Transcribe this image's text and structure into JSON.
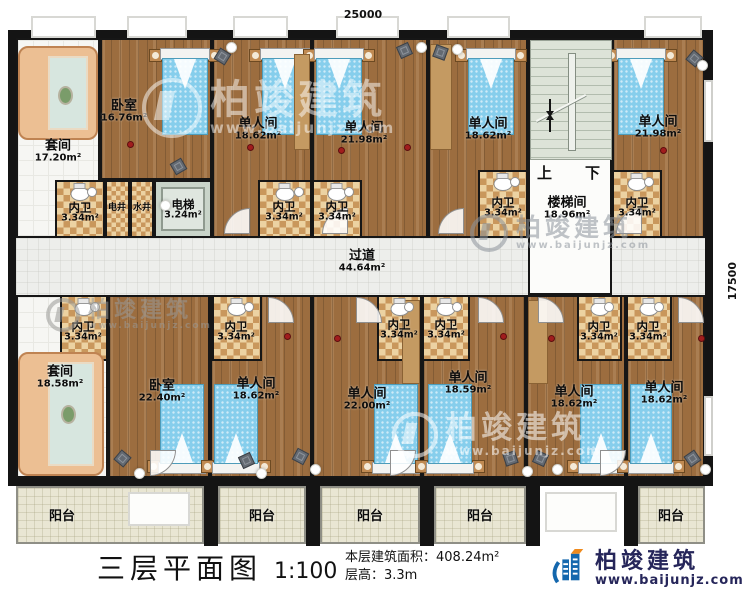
{
  "watermark": {
    "brand": "柏竣建筑",
    "url": "www.baijunjz.com"
  },
  "title_block": {
    "title": "三层平面图",
    "scale": "1:100",
    "area_line": "本层建筑面积：408.24m²",
    "height_line": "层高：3.3m",
    "brand": "柏竣建筑",
    "website": "www.baijunjz.com"
  },
  "plan": {
    "dims": {
      "top": "25000",
      "right": "17500"
    },
    "stairs": {
      "up": "上",
      "down": "下"
    },
    "rooms": [
      {
        "id": "room-suite-top",
        "type": "suite",
        "name": "套间",
        "area": "17.20m²",
        "x": 16,
        "y": 38,
        "w": 84,
        "h": 200,
        "lx": 58,
        "ly": 152
      },
      {
        "id": "room-bedroom-top",
        "type": "wood",
        "name": "卧室",
        "area": "16.76m²",
        "x": 100,
        "y": 38,
        "w": 112,
        "h": 142,
        "lx": 124,
        "ly": 112
      },
      {
        "id": "room-single-top-1",
        "type": "wood",
        "name": "单人间",
        "area": "18.62m²",
        "x": 212,
        "y": 38,
        "w": 100,
        "h": 200,
        "lx": 258,
        "ly": 130
      },
      {
        "id": "room-single-top-2",
        "type": "wood",
        "name": "单人间",
        "area": "21.98m²",
        "x": 312,
        "y": 38,
        "w": 116,
        "h": 200,
        "lx": 364,
        "ly": 134
      },
      {
        "id": "room-single-top-3",
        "type": "wood",
        "name": "单人间",
        "area": "18.62m²",
        "x": 428,
        "y": 38,
        "w": 100,
        "h": 200,
        "lx": 488,
        "ly": 130
      },
      {
        "id": "room-single-top-4",
        "type": "wood",
        "name": "单人间",
        "area": "21.98m²",
        "x": 612,
        "y": 38,
        "w": 93,
        "h": 200,
        "lx": 658,
        "ly": 128
      },
      {
        "id": "room-corridor",
        "type": "corridor",
        "name": "过道",
        "area": "44.64m²",
        "x": 16,
        "y": 238,
        "w": 689,
        "h": 57,
        "lx": 362,
        "ly": 262
      },
      {
        "id": "room-stairwell",
        "type": "stairw",
        "name": "楼梯间",
        "area": "18.96m²",
        "x": 528,
        "y": 38,
        "w": 84,
        "h": 257,
        "lx": 567,
        "ly": 209
      },
      {
        "id": "room-suite-bottom",
        "type": "suite",
        "name": "套间",
        "area": "18.58m²",
        "x": 16,
        "y": 295,
        "w": 92,
        "h": 183,
        "lx": 60,
        "ly": 378
      },
      {
        "id": "room-bedroom-bottom",
        "type": "wood",
        "name": "卧室",
        "area": "22.40m²",
        "x": 108,
        "y": 295,
        "w": 102,
        "h": 183,
        "lx": 162,
        "ly": 392
      },
      {
        "id": "room-single-bot-1",
        "type": "wood",
        "name": "单人间",
        "area": "18.62m²",
        "x": 210,
        "y": 295,
        "w": 102,
        "h": 183,
        "lx": 256,
        "ly": 390
      },
      {
        "id": "room-single-bot-2",
        "type": "wood",
        "name": "单人间",
        "area": "22.00m²",
        "x": 312,
        "y": 295,
        "w": 110,
        "h": 183,
        "lx": 367,
        "ly": 400
      },
      {
        "id": "room-single-bot-3",
        "type": "wood",
        "name": "单人间",
        "area": "18.59m²",
        "x": 422,
        "y": 295,
        "w": 104,
        "h": 183,
        "lx": 468,
        "ly": 384
      },
      {
        "id": "room-single-bot-4",
        "type": "wood",
        "name": "单人间",
        "area": "18.62m²",
        "x": 526,
        "y": 295,
        "w": 100,
        "h": 183,
        "lx": 574,
        "ly": 398
      },
      {
        "id": "room-single-bot-5",
        "type": "wood",
        "name": "单人间",
        "area": "18.62m²",
        "x": 626,
        "y": 295,
        "w": 79,
        "h": 183,
        "lx": 664,
        "ly": 394
      },
      {
        "id": "bath-top-1",
        "type": "bath",
        "s": "sm",
        "name": "内卫",
        "area": "3.34m²",
        "x": 55,
        "y": 180,
        "w": 50,
        "h": 58,
        "lx": 80,
        "ly": 213
      },
      {
        "id": "shaft-electric",
        "type": "shaft",
        "s": "xs",
        "name": "电井",
        "x": 105,
        "y": 180,
        "w": 25,
        "h": 58,
        "lx": 117,
        "ly": 209
      },
      {
        "id": "shaft-water",
        "type": "shaft",
        "s": "xs",
        "name": "水井",
        "x": 130,
        "y": 180,
        "w": 24,
        "h": 58,
        "lx": 142,
        "ly": 209
      },
      {
        "id": "elevator",
        "type": "elev",
        "s": "sm",
        "name": "电梯",
        "area": "3.24m²",
        "x": 154,
        "y": 180,
        "w": 58,
        "h": 58,
        "lx": 183,
        "ly": 210
      },
      {
        "id": "bath-top-2",
        "type": "bath",
        "s": "sm",
        "name": "内卫",
        "area": "3.34m²",
        "x": 258,
        "y": 180,
        "w": 54,
        "h": 58,
        "lx": 284,
        "ly": 212
      },
      {
        "id": "bath-top-3",
        "type": "bath",
        "s": "sm",
        "name": "内卫",
        "area": "3.34m²",
        "x": 312,
        "y": 180,
        "w": 50,
        "h": 58,
        "lx": 337,
        "ly": 212
      },
      {
        "id": "bath-top-4",
        "type": "bath",
        "s": "sm",
        "name": "内卫",
        "area": "3.34m²",
        "x": 478,
        "y": 170,
        "w": 50,
        "h": 68,
        "lx": 503,
        "ly": 208
      },
      {
        "id": "bath-top-5",
        "type": "bath",
        "s": "sm",
        "name": "内卫",
        "area": "3.34m²",
        "x": 612,
        "y": 170,
        "w": 50,
        "h": 68,
        "lx": 637,
        "ly": 208
      },
      {
        "id": "bath-bot-1",
        "type": "bath",
        "s": "sm",
        "name": "内卫",
        "area": "3.34m²",
        "x": 60,
        "y": 295,
        "w": 48,
        "h": 66,
        "lx": 83,
        "ly": 332
      },
      {
        "id": "bath-bot-2",
        "type": "bath",
        "s": "sm",
        "name": "内卫",
        "area": "3.34m²",
        "x": 212,
        "y": 295,
        "w": 50,
        "h": 66,
        "lx": 236,
        "ly": 332
      },
      {
        "id": "bath-bot-3",
        "type": "bath",
        "s": "sm",
        "name": "内卫",
        "area": "3.34m²",
        "x": 377,
        "y": 295,
        "w": 45,
        "h": 66,
        "lx": 399,
        "ly": 330
      },
      {
        "id": "bath-bot-4",
        "type": "bath",
        "s": "sm",
        "name": "内卫",
        "area": "3.34m²",
        "x": 422,
        "y": 295,
        "w": 48,
        "h": 66,
        "lx": 446,
        "ly": 330
      },
      {
        "id": "bath-bot-5",
        "type": "bath",
        "s": "sm",
        "name": "内卫",
        "area": "3.34m²",
        "x": 577,
        "y": 295,
        "w": 45,
        "h": 66,
        "lx": 599,
        "ly": 332
      },
      {
        "id": "bath-bot-6",
        "type": "bath",
        "s": "sm",
        "name": "内卫",
        "area": "3.34m²",
        "x": 626,
        "y": 295,
        "w": 46,
        "h": 66,
        "lx": 648,
        "ly": 332
      },
      {
        "id": "balcony-1",
        "type": "balcony",
        "name": "阳台",
        "x": 16,
        "y": 486,
        "w": 188,
        "h": 58,
        "lx": 62,
        "ly": 517
      },
      {
        "id": "balcony-2",
        "type": "balcony",
        "name": "阳台",
        "x": 218,
        "y": 486,
        "w": 88,
        "h": 58,
        "lx": 262,
        "ly": 517
      },
      {
        "id": "balcony-3",
        "type": "balcony",
        "name": "阳台",
        "x": 320,
        "y": 486,
        "w": 100,
        "h": 58,
        "lx": 370,
        "ly": 517
      },
      {
        "id": "balcony-4",
        "type": "balcony",
        "name": "阳台",
        "x": 434,
        "y": 486,
        "w": 92,
        "h": 58,
        "lx": 480,
        "ly": 517
      },
      {
        "id": "balcony-5",
        "type": "balcony",
        "name": "阳台",
        "x": 638,
        "y": 486,
        "w": 67,
        "h": 58,
        "lx": 671,
        "ly": 517
      }
    ],
    "items": [
      {
        "k": "bed",
        "dir": "top",
        "x": 162,
        "y": 50,
        "w": 46,
        "h": 85
      },
      {
        "k": "bed",
        "dir": "top",
        "x": 262,
        "y": 50,
        "w": 46,
        "h": 85
      },
      {
        "k": "bed",
        "dir": "top",
        "x": 316,
        "y": 50,
        "w": 46,
        "h": 85
      },
      {
        "k": "bed",
        "dir": "top",
        "x": 468,
        "y": 50,
        "w": 46,
        "h": 85
      },
      {
        "k": "bed",
        "dir": "top",
        "x": 618,
        "y": 50,
        "w": 46,
        "h": 85
      },
      {
        "k": "bed",
        "dir": "bottom",
        "x": 160,
        "y": 384,
        "w": 44,
        "h": 88
      },
      {
        "k": "bed",
        "dir": "bottom",
        "x": 214,
        "y": 384,
        "w": 44,
        "h": 88
      },
      {
        "k": "bed",
        "dir": "bottom",
        "x": 374,
        "y": 384,
        "w": 44,
        "h": 88
      },
      {
        "k": "bed",
        "dir": "bottom",
        "x": 428,
        "y": 384,
        "w": 44,
        "h": 88
      },
      {
        "k": "bed",
        "dir": "bottom",
        "x": 580,
        "y": 384,
        "w": 42,
        "h": 88
      },
      {
        "k": "bed",
        "dir": "bottom",
        "x": 630,
        "y": 384,
        "w": 42,
        "h": 88
      },
      {
        "k": "sofa",
        "x": 18,
        "y": 46,
        "w": 80,
        "h": 94
      },
      {
        "k": "sofa",
        "x": 18,
        "y": 352,
        "w": 86,
        "h": 124
      },
      {
        "k": "ward",
        "x": 294,
        "y": 54,
        "w": 16,
        "h": 96
      },
      {
        "k": "ward",
        "x": 430,
        "y": 44,
        "w": 22,
        "h": 106
      },
      {
        "k": "ward",
        "x": 402,
        "y": 300,
        "w": 18,
        "h": 84
      },
      {
        "k": "ward",
        "x": 528,
        "y": 300,
        "w": 20,
        "h": 84
      },
      {
        "k": "chair",
        "x": 216,
        "y": 50,
        "r": 32
      },
      {
        "k": "chair",
        "x": 398,
        "y": 44,
        "r": -24
      },
      {
        "k": "chair",
        "x": 434,
        "y": 46,
        "r": 20
      },
      {
        "k": "chair",
        "x": 688,
        "y": 52,
        "r": 40
      },
      {
        "k": "chair",
        "x": 172,
        "y": 160,
        "r": -30
      },
      {
        "k": "chair",
        "x": 116,
        "y": 452,
        "r": 40
      },
      {
        "k": "chair",
        "x": 240,
        "y": 454,
        "r": -25
      },
      {
        "k": "chair",
        "x": 294,
        "y": 450,
        "r": 28
      },
      {
        "k": "chair",
        "x": 504,
        "y": 452,
        "r": -18
      },
      {
        "k": "chair",
        "x": 534,
        "y": 452,
        "r": 24
      },
      {
        "k": "chair",
        "x": 686,
        "y": 452,
        "r": -35
      },
      {
        "k": "lamp",
        "x": 226,
        "y": 42
      },
      {
        "k": "lamp",
        "x": 416,
        "y": 42
      },
      {
        "k": "lamp",
        "x": 452,
        "y": 44
      },
      {
        "k": "lamp",
        "x": 697,
        "y": 60
      },
      {
        "k": "lamp",
        "x": 160,
        "y": 200
      },
      {
        "k": "lamp",
        "x": 134,
        "y": 468
      },
      {
        "k": "lamp",
        "x": 256,
        "y": 468
      },
      {
        "k": "lamp",
        "x": 310,
        "y": 464
      },
      {
        "k": "lamp",
        "x": 522,
        "y": 466
      },
      {
        "k": "lamp",
        "x": 552,
        "y": 464
      },
      {
        "k": "lamp",
        "x": 700,
        "y": 464
      },
      {
        "k": "dot",
        "x": 127,
        "y": 141
      },
      {
        "k": "dot",
        "x": 247,
        "y": 144
      },
      {
        "k": "dot",
        "x": 338,
        "y": 147
      },
      {
        "k": "dot",
        "x": 404,
        "y": 144
      },
      {
        "k": "dot",
        "x": 660,
        "y": 147
      },
      {
        "k": "dot",
        "x": 284,
        "y": 333
      },
      {
        "k": "dot",
        "x": 334,
        "y": 335
      },
      {
        "k": "dot",
        "x": 500,
        "y": 333
      },
      {
        "k": "dot",
        "x": 548,
        "y": 335
      },
      {
        "k": "dot",
        "x": 698,
        "y": 335
      },
      {
        "k": "door",
        "x": 224,
        "y": 208,
        "r": 0
      },
      {
        "k": "door",
        "x": 322,
        "y": 208,
        "r": 0
      },
      {
        "k": "door",
        "x": 438,
        "y": 208,
        "r": 0
      },
      {
        "k": "door",
        "x": 616,
        "y": 208,
        "r": 0
      },
      {
        "k": "door",
        "x": 268,
        "y": 297,
        "r": 90
      },
      {
        "k": "door",
        "x": 356,
        "y": 297,
        "r": 90
      },
      {
        "k": "door",
        "x": 478,
        "y": 297,
        "r": 90
      },
      {
        "k": "door",
        "x": 538,
        "y": 297,
        "r": 90
      },
      {
        "k": "door",
        "x": 678,
        "y": 297,
        "r": 90
      },
      {
        "k": "door",
        "x": 150,
        "y": 450,
        "r": 180
      },
      {
        "k": "door",
        "x": 390,
        "y": 450,
        "r": 180
      },
      {
        "k": "door",
        "x": 600,
        "y": 450,
        "r": 180
      },
      {
        "k": "pier",
        "x": 204,
        "y": 480,
        "w": 14,
        "h": 66
      },
      {
        "k": "pier",
        "x": 306,
        "y": 480,
        "w": 14,
        "h": 66
      },
      {
        "k": "pier",
        "x": 420,
        "y": 480,
        "w": 14,
        "h": 66
      },
      {
        "k": "pier",
        "x": 526,
        "y": 480,
        "w": 14,
        "h": 66
      },
      {
        "k": "pier",
        "x": 624,
        "y": 480,
        "w": 14,
        "h": 66
      },
      {
        "k": "sill",
        "x": 31,
        "y": 16,
        "w": 65,
        "h": 22
      },
      {
        "k": "sill",
        "x": 127,
        "y": 16,
        "w": 60,
        "h": 22
      },
      {
        "k": "sill",
        "x": 233,
        "y": 16,
        "w": 55,
        "h": 22
      },
      {
        "k": "sill",
        "x": 336,
        "y": 16,
        "w": 63,
        "h": 22
      },
      {
        "k": "sill",
        "x": 447,
        "y": 16,
        "w": 63,
        "h": 22
      },
      {
        "k": "sill",
        "x": 644,
        "y": 16,
        "w": 58,
        "h": 22
      },
      {
        "k": "rwin",
        "x": 704,
        "y": 80,
        "w": 9,
        "h": 62
      },
      {
        "k": "rwin",
        "x": 704,
        "y": 396,
        "w": 9,
        "h": 60
      },
      {
        "k": "wrect",
        "x": 128,
        "y": 492,
        "w": 62,
        "h": 34
      },
      {
        "k": "wrect",
        "x": 545,
        "y": 492,
        "w": 72,
        "h": 40
      }
    ]
  }
}
